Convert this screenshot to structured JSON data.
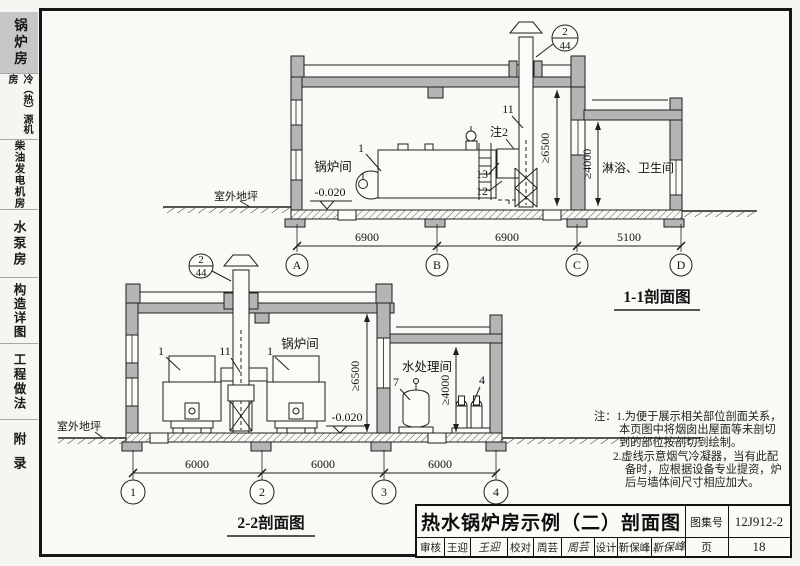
{
  "colors": {
    "active_tab_bg": "#c7c7c7",
    "line": "#1f1f1f",
    "wall_fill": "#b5b5b5"
  },
  "sidebar": {
    "tabs": [
      {
        "label": "锅炉房"
      },
      {
        "label": "冷（热）源机房"
      },
      {
        "label": "柴油发电机房"
      },
      {
        "label": "水泵房"
      },
      {
        "label": "构造详图"
      },
      {
        "label": "工程做法"
      },
      {
        "label": "附录"
      }
    ]
  },
  "section1": {
    "caption": "1-1剖面图",
    "room_boiler": "锅炉间",
    "room_shower": "淋浴、卫生间",
    "outdoor_ground": "室外地坪",
    "level": "-0.020",
    "detail_ref_num": "2",
    "detail_ref_page": "44",
    "tag_boiler": "1",
    "tag_chimney": "11",
    "tag_note2": "注2",
    "tag_13": "13",
    "tag_12": "12",
    "dim_height_main": "≥6500",
    "dim_height_annex": "≥4000",
    "span_ab": "6900",
    "span_bc": "6900",
    "span_cd": "5100",
    "grid_a": "A",
    "grid_b": "B",
    "grid_c": "C",
    "grid_d": "D"
  },
  "section2": {
    "caption": "2-2剖面图",
    "room_boiler": "锅炉间",
    "room_water": "水处理间",
    "outdoor_ground": "室外地坪",
    "level": "-0.020",
    "detail_ref_num": "2",
    "detail_ref_page": "44",
    "tag_boiler_left": "1",
    "tag_boiler_right": "1",
    "tag_chimney": "11",
    "tag_tank": "7",
    "tag_pumps": "4",
    "dim_height_main": "≥6500",
    "dim_height_annex": "≥4000",
    "span_12": "6000",
    "span_23": "6000",
    "span_34": "6000",
    "grid_1": "1",
    "grid_2": "2",
    "grid_3": "3",
    "grid_4": "4"
  },
  "notes": {
    "line1": "注：1.为便于展示相关部位剖面关系，",
    "line2": "本页图中将烟囱出屋面等未剖切",
    "line3": "到的部位按剖切到绘制。",
    "line4": "2.虚线示意烟气冷凝器，当有此配",
    "line5": "备时，应根据设备专业提资，炉",
    "line6": "后与墙体间尺寸相应加大。"
  },
  "titleblock": {
    "title": "热水锅炉房示例（二）剖面图",
    "atlas_label": "图集号",
    "atlas_no": "12J912-2",
    "page_label": "页",
    "page_no": "18",
    "reviewer_label": "审核",
    "reviewer_name": "王迎",
    "reviewer_sign": "王迎",
    "checker_label": "校对",
    "checker_name": "周芸",
    "checker_sign": "周芸",
    "designer_label": "设计",
    "designer_name": "靳保峰",
    "designer_sign": "靳保峰"
  }
}
